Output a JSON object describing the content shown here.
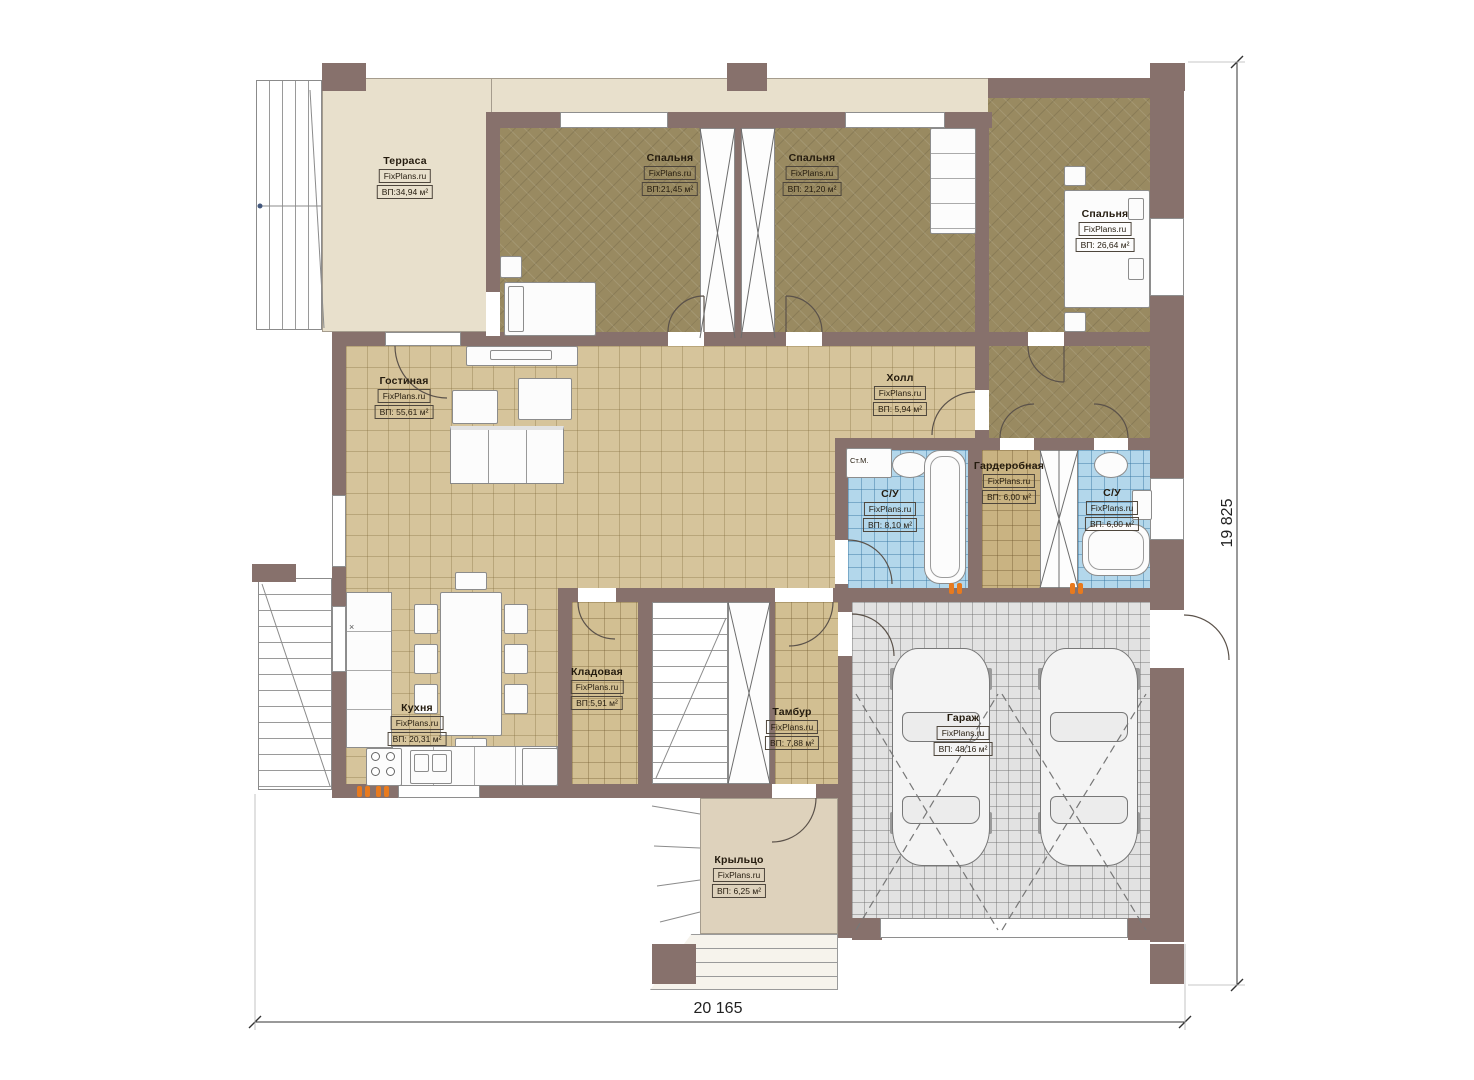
{
  "brand": "FixPlans.ru",
  "dimensions": {
    "width": "20 165",
    "height": "19 825"
  },
  "rooms": {
    "terrace": {
      "name": "Терраса",
      "brand": "FixPlans.ru",
      "area": "ВП:34,94 м²"
    },
    "bedroom1": {
      "name": "Спальня",
      "brand": "FixPlans.ru",
      "area": "ВП:21,45 м²"
    },
    "bedroom2": {
      "name": "Спальня",
      "brand": "FixPlans.ru",
      "area": "ВП: 21,20 м²"
    },
    "bedroom3": {
      "name": "Спальня",
      "brand": "FixPlans.ru",
      "area": "ВП: 26,64 м²"
    },
    "living": {
      "name": "Гостиная",
      "brand": "FixPlans.ru",
      "area": "ВП: 55,61 м²"
    },
    "hall": {
      "name": "Холл",
      "brand": "FixPlans.ru",
      "area": "ВП: 5,94 м²"
    },
    "bathroom1": {
      "name": "С/У",
      "brand": "FixPlans.ru",
      "area": "ВП: 8,10 м²"
    },
    "wardrobe": {
      "name": "Гардеробная",
      "brand": "FixPlans.ru",
      "area": "ВП: 6,00 м²"
    },
    "bathroom2": {
      "name": "С/У",
      "brand": "FixPlans.ru",
      "area": "ВП: 6,00 м²"
    },
    "kitchen": {
      "name": "Кухня",
      "brand": "FixPlans.ru",
      "area": "ВП: 20,31 м²"
    },
    "storage": {
      "name": "Кладовая",
      "brand": "FixPlans.ru",
      "area": "ВП:5,91 м²"
    },
    "vestibule": {
      "name": "Тамбур",
      "brand": "FixPlans.ru",
      "area": "ВП: 7,88 м²"
    },
    "garage": {
      "name": "Гараж",
      "brand": "FixPlans.ru",
      "area": "ВП: 48,16 м²"
    },
    "porch": {
      "name": "Крыльцо",
      "brand": "FixPlans.ru",
      "area": "ВП: 6,25 м²"
    }
  },
  "annotations": {
    "washing_machine": "Ст.М.",
    "counter_mark": "×"
  },
  "colors": {
    "wall": "#87716c",
    "terrace_floor": "#e8e0cc",
    "bedroom_floor": "#998a61",
    "living_floor": "#d6c49b",
    "bath_floor": "#b3d7eb",
    "garage_floor": "#e2e2e2",
    "porch_floor": "#ded2bc",
    "radiator": "#e87a1e"
  }
}
